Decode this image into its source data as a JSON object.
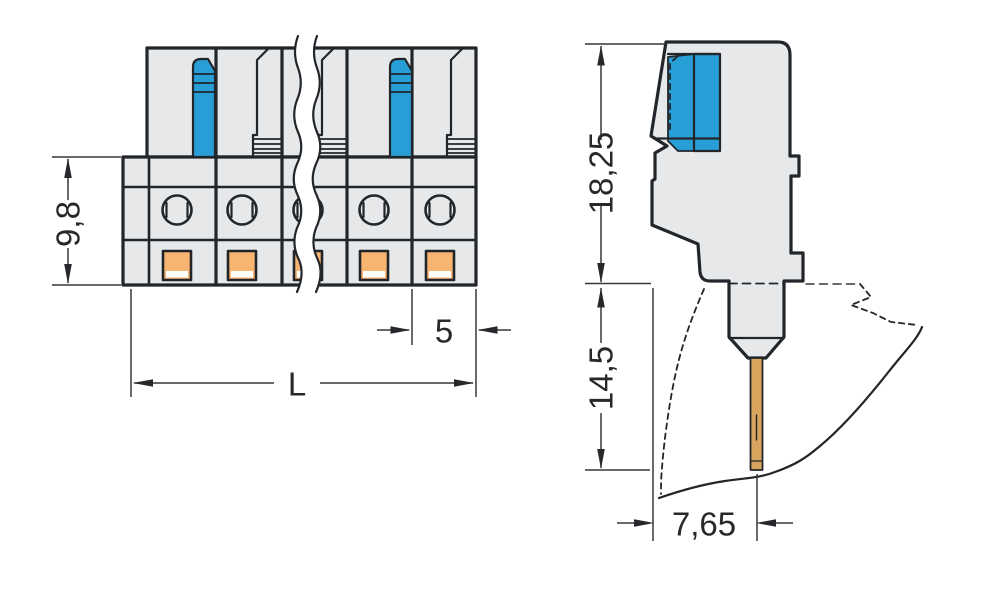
{
  "diagram": {
    "kind": "technical-dimension-drawing",
    "subject": "multi-pole-female-connector",
    "views": {
      "front": {
        "poles_visible": 5,
        "has_break_lines": true,
        "dims": {
          "height": "9,8",
          "pitch": "5",
          "length": "L"
        }
      },
      "side": {
        "dims": {
          "height_above_panel": "18,25",
          "depth_below_panel": "14,5",
          "pin_to_face": "7,65"
        }
      }
    },
    "colors": {
      "background": "#ffffff",
      "body": "#e6e8ea",
      "lever": "#279fd6",
      "contact": "#f8b571",
      "pin": "#d9a55e",
      "outline": "#22262a",
      "dimline": "#35393d",
      "text": "#26282b"
    }
  }
}
